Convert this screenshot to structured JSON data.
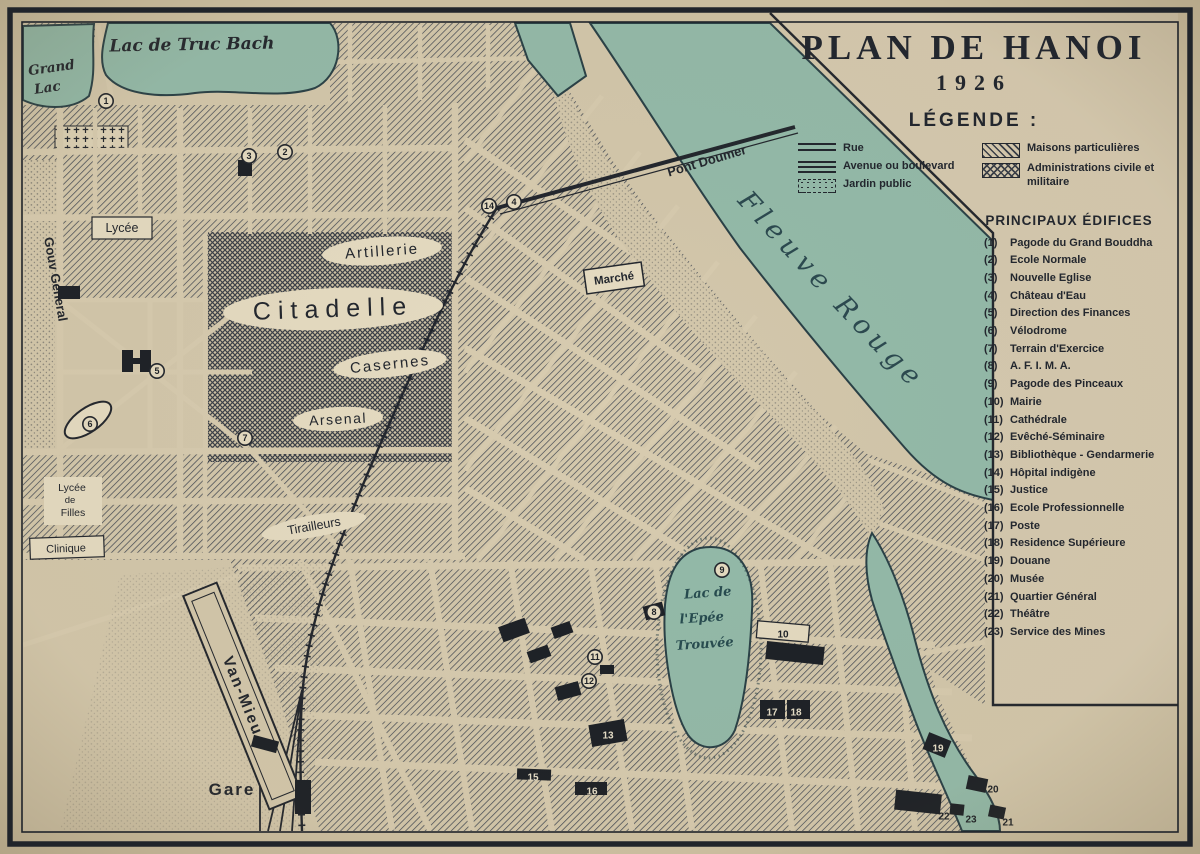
{
  "title": {
    "main": "PLAN DE HANOI",
    "year": "1926"
  },
  "legend": {
    "heading": "LÉGENDE :",
    "left_items": [
      {
        "symbol": "rue",
        "label": "Rue"
      },
      {
        "symbol": "avenue",
        "label": "Avenue ou boulevard"
      },
      {
        "symbol": "jardin",
        "label": "Jardin public"
      }
    ],
    "right_items": [
      {
        "symbol": "maisons",
        "label": "Maisons particulières"
      },
      {
        "symbol": "administrations",
        "label": "Administrations civile et militaire"
      }
    ]
  },
  "edifices": {
    "heading": "PRINCIPAUX ÉDIFICES",
    "items": [
      {
        "num": "(1)",
        "name": "Pagode du Grand Bouddha"
      },
      {
        "num": "(2)",
        "name": "Ecole Normale"
      },
      {
        "num": "(3)",
        "name": "Nouvelle Eglise"
      },
      {
        "num": "(4)",
        "name": "Château d'Eau"
      },
      {
        "num": "(5)",
        "name": "Direction des Finances"
      },
      {
        "num": "(6)",
        "name": "Vélodrome"
      },
      {
        "num": "(7)",
        "name": "Terrain d'Exercice"
      },
      {
        "num": "(8)",
        "name": "A. F. I. M. A."
      },
      {
        "num": "(9)",
        "name": "Pagode des Pinceaux"
      },
      {
        "num": "(10)",
        "name": "Mairie"
      },
      {
        "num": "(11)",
        "name": "Cathédrale"
      },
      {
        "num": "(12)",
        "name": "Evêché-Séminaire"
      },
      {
        "num": "(13)",
        "name": "Bibliothèque - Gendarmerie"
      },
      {
        "num": "(14)",
        "name": "Hôpital indigène"
      },
      {
        "num": "(15)",
        "name": "Justice"
      },
      {
        "num": "(16)",
        "name": "Ecole Professionnelle"
      },
      {
        "num": "(17)",
        "name": "Poste"
      },
      {
        "num": "(18)",
        "name": "Residence Supérieure"
      },
      {
        "num": "(19)",
        "name": "Douane"
      },
      {
        "num": "(20)",
        "name": "Musée"
      },
      {
        "num": "(21)",
        "name": "Quartier Général"
      },
      {
        "num": "(22)",
        "name": "Théâtre"
      },
      {
        "num": "(23)",
        "name": "Service des Mines"
      }
    ]
  },
  "map": {
    "labels": {
      "lac_truc_bach": "Lac de Truc Bach",
      "grand_lac_1": "Grand",
      "grand_lac_2": "Lac",
      "gouv_general": "Gouv General",
      "lycee": "Lycée",
      "artillerie": "Artillerie",
      "citadelle": "Citadelle",
      "casernes": "Casernes",
      "arsenal": "Arsenal",
      "tirailleurs": "Tirailleurs",
      "marche": "Marché",
      "pont_doumer": "Pont Doumer",
      "fleuve_rouge": "Fleuve Rouge",
      "lac_epee_1": "Lac de",
      "lac_epee_2": "l'Epée",
      "lac_epee_3": "Trouvée",
      "van_mieu": "Van-Mieu",
      "gare": "Gare",
      "clinique": "Clinique",
      "lycee_filles_1": "Lycée",
      "lycee_filles_2": "de",
      "lycee_filles_3": "Filles"
    },
    "markers": [
      {
        "n": "1",
        "x": 106,
        "y": 101,
        "style": "circle"
      },
      {
        "n": "2",
        "x": 285,
        "y": 152,
        "style": "circle"
      },
      {
        "n": "3",
        "x": 249,
        "y": 156,
        "style": "circle"
      },
      {
        "n": "4",
        "x": 514,
        "y": 202,
        "style": "circle"
      },
      {
        "n": "5",
        "x": 157,
        "y": 371,
        "style": "circle"
      },
      {
        "n": "6",
        "x": 90,
        "y": 424,
        "style": "circle"
      },
      {
        "n": "7",
        "x": 245,
        "y": 438,
        "style": "circle"
      },
      {
        "n": "8",
        "x": 654,
        "y": 612,
        "style": "circle"
      },
      {
        "n": "9",
        "x": 722,
        "y": 570,
        "style": "circle"
      },
      {
        "n": "10",
        "x": 783,
        "y": 634,
        "style": "plain"
      },
      {
        "n": "11",
        "x": 595,
        "y": 657,
        "style": "circle"
      },
      {
        "n": "12",
        "x": 589,
        "y": 681,
        "style": "circle"
      },
      {
        "n": "13",
        "x": 608,
        "y": 735,
        "style": "white"
      },
      {
        "n": "14",
        "x": 489,
        "y": 206,
        "style": "circle"
      },
      {
        "n": "15",
        "x": 533,
        "y": 777,
        "style": "white"
      },
      {
        "n": "16",
        "x": 592,
        "y": 791,
        "style": "white"
      },
      {
        "n": "17",
        "x": 772,
        "y": 712,
        "style": "white"
      },
      {
        "n": "18",
        "x": 796,
        "y": 712,
        "style": "white"
      },
      {
        "n": "19",
        "x": 938,
        "y": 748,
        "style": "white"
      },
      {
        "n": "20",
        "x": 993,
        "y": 789,
        "style": "plain"
      },
      {
        "n": "21",
        "x": 1008,
        "y": 822,
        "style": "plain"
      },
      {
        "n": "22",
        "x": 944,
        "y": 816,
        "style": "plain"
      },
      {
        "n": "23",
        "x": 971,
        "y": 819,
        "style": "plain"
      }
    ],
    "buildings": [
      {
        "x": 122,
        "y": 350,
        "w": 11,
        "h": 22,
        "r": 0
      },
      {
        "x": 140,
        "y": 350,
        "w": 11,
        "h": 22,
        "r": 0
      },
      {
        "x": 128,
        "y": 358,
        "w": 20,
        "h": 6,
        "r": 0
      },
      {
        "x": 238,
        "y": 160,
        "w": 14,
        "h": 16,
        "r": 0
      },
      {
        "x": 58,
        "y": 286,
        "w": 22,
        "h": 13,
        "r": 0
      },
      {
        "x": 644,
        "y": 604,
        "w": 20,
        "h": 14,
        "r": -15
      },
      {
        "x": 500,
        "y": 622,
        "w": 28,
        "h": 16,
        "r": -20
      },
      {
        "x": 528,
        "y": 648,
        "w": 22,
        "h": 12,
        "r": -20
      },
      {
        "x": 552,
        "y": 624,
        "w": 20,
        "h": 12,
        "r": -20
      },
      {
        "x": 556,
        "y": 684,
        "w": 24,
        "h": 14,
        "r": -15
      },
      {
        "x": 600,
        "y": 665,
        "w": 14,
        "h": 9,
        "r": 0
      },
      {
        "x": 590,
        "y": 722,
        "w": 36,
        "h": 22,
        "r": -10
      },
      {
        "x": 517,
        "y": 769,
        "w": 34,
        "h": 11,
        "r": 2
      },
      {
        "x": 575,
        "y": 782,
        "w": 32,
        "h": 13,
        "r": 0
      },
      {
        "x": 760,
        "y": 700,
        "w": 25,
        "h": 19,
        "r": 0
      },
      {
        "x": 787,
        "y": 700,
        "w": 23,
        "h": 19,
        "r": 0
      },
      {
        "x": 766,
        "y": 644,
        "w": 58,
        "h": 18,
        "r": 6
      },
      {
        "x": 925,
        "y": 736,
        "w": 24,
        "h": 18,
        "r": 22
      },
      {
        "x": 895,
        "y": 792,
        "w": 46,
        "h": 20,
        "r": 6
      },
      {
        "x": 967,
        "y": 777,
        "w": 20,
        "h": 14,
        "r": 12
      },
      {
        "x": 989,
        "y": 806,
        "w": 16,
        "h": 12,
        "r": 12
      },
      {
        "x": 950,
        "y": 804,
        "w": 14,
        "h": 11,
        "r": 6
      },
      {
        "x": 295,
        "y": 780,
        "w": 16,
        "h": 34,
        "r": 0
      },
      {
        "x": 252,
        "y": 738,
        "w": 26,
        "h": 12,
        "r": 15
      }
    ]
  },
  "colors": {
    "paper": "#cfc2a4",
    "map_paper": "#d4c8ac",
    "ink": "#23272e",
    "water": "#94bbaa",
    "water_edge": "#2a4147",
    "hatch": "#4a4f58",
    "plate": "#e6dcc2"
  }
}
